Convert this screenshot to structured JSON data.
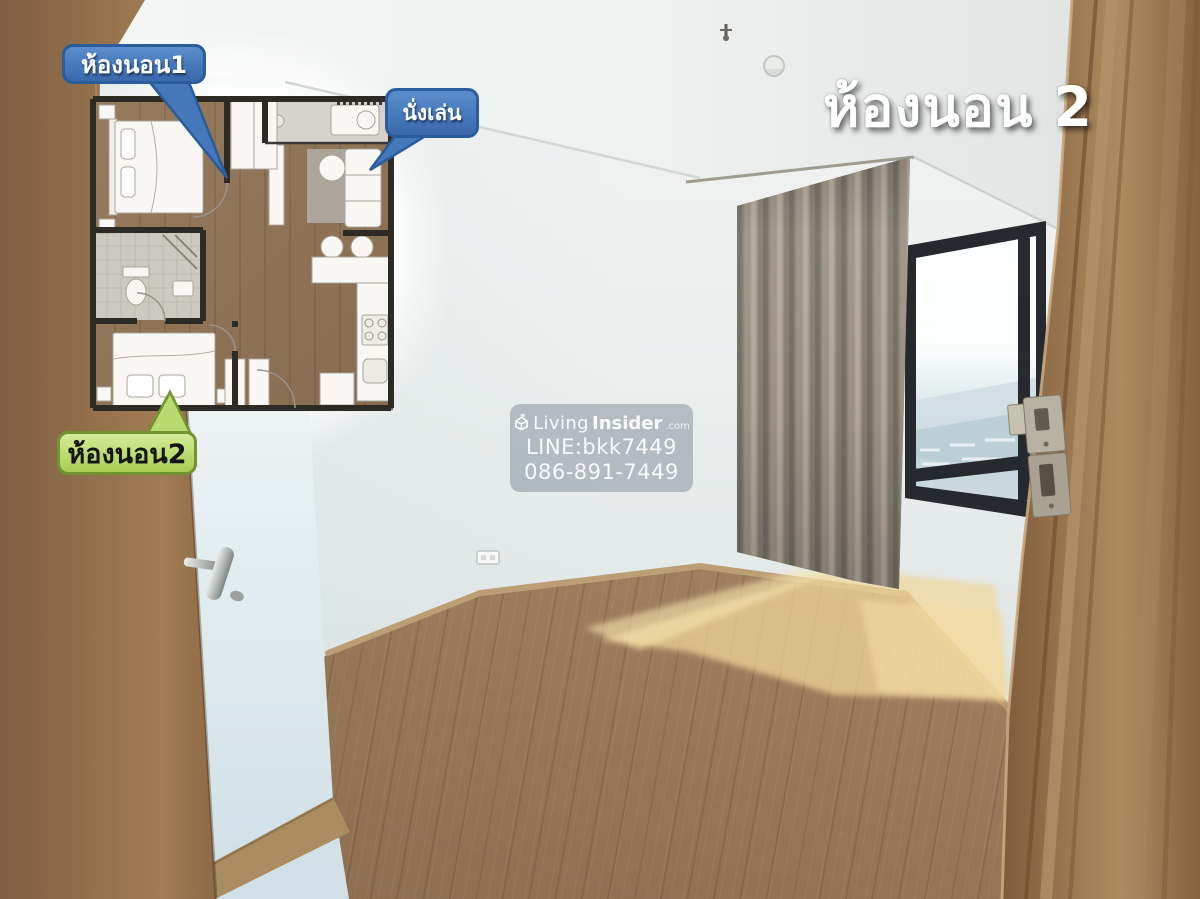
{
  "title": {
    "text": "ห้องนอน 2"
  },
  "floorplan_labels": {
    "bedroom1": "ห้องนอน1",
    "living": "นั่งเล่น",
    "bedroom2": "ห้องนอน2"
  },
  "watermark": {
    "brand_first": "Living",
    "brand_second": "Insider",
    "brand_tld": ".com",
    "line_id": "LINE:bkk7449",
    "phone": "086-891-7449"
  },
  "colors": {
    "blue_bubble": "#4679bb",
    "blue_bubble_border": "#2b5c9c",
    "green_label": "#b9da6e",
    "green_border": "#6f9430",
    "title_color": "#ffffff",
    "curtain": "#948c7e",
    "wood_floor": "#9a7c5c",
    "door_wood": "#9b7850",
    "plan_wood": "#8f7458",
    "watermark_bg": "#8f98a4",
    "window_frame": "#26292d"
  }
}
